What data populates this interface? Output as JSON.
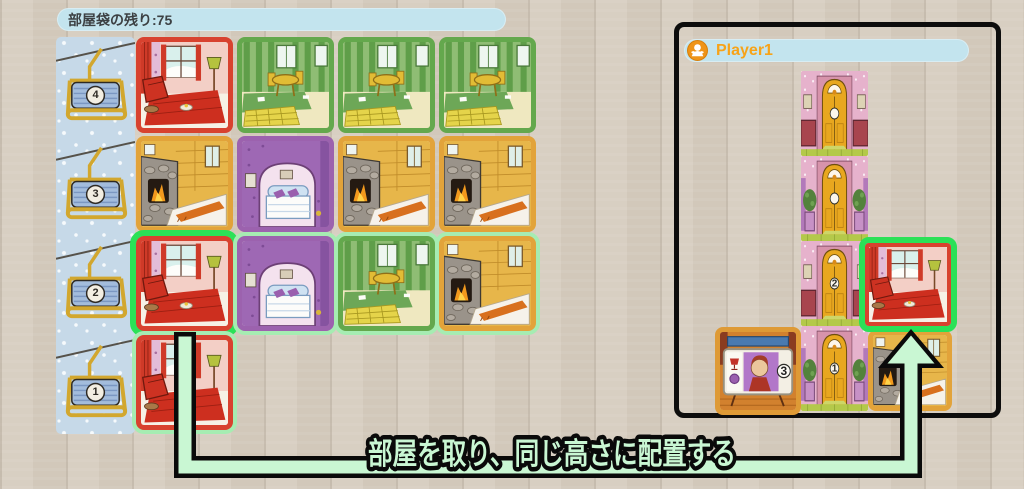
{
  "labels": {
    "bag_remaining": "部屋袋の残り:75",
    "instruction": "部屋を取り、同じ高さに配置する"
  },
  "market": {
    "chairlifts": [
      {
        "number": "4"
      },
      {
        "number": "3"
      },
      {
        "number": "2"
      },
      {
        "number": "1"
      }
    ],
    "rows": [
      [
        "living-room",
        "dining-room",
        "dining-room",
        "dining-room"
      ],
      [
        "fireplace-room",
        "bedroom",
        "fireplace-room",
        "fireplace-room"
      ],
      [
        "living-room",
        "bedroom",
        "dining-room",
        "fireplace-room"
      ],
      [
        "living-room"
      ]
    ],
    "selected_tile": {
      "row": 2,
      "col": 0,
      "type": "living-room"
    }
  },
  "player": {
    "name": "Player1",
    "tower": [
      {
        "type": "entrance-a",
        "number": ""
      },
      {
        "type": "entrance-b",
        "number": ""
      },
      {
        "type": "entrance-a",
        "number": "2"
      },
      {
        "type": "entrance-b",
        "number": "1"
      }
    ],
    "placed_room": "living-room",
    "ground_room": "fireplace-room",
    "character_card": {
      "badge_number": "3",
      "icons": [
        "lamp-icon",
        "yarn-ball-icon"
      ]
    }
  },
  "colors": {
    "selection_green": "#2be157",
    "glow_green": "#a6ecb2",
    "arrow_fill": "#c9f7d3",
    "arrow_outline": "#0a0a0a",
    "pill_blue": "#c3e4ee",
    "player_name_orange": "#f7a318",
    "border_red": "#d8422f",
    "border_green": "#64a84d",
    "border_orange": "#e2a33a",
    "border_purple": "#9c62ae"
  }
}
